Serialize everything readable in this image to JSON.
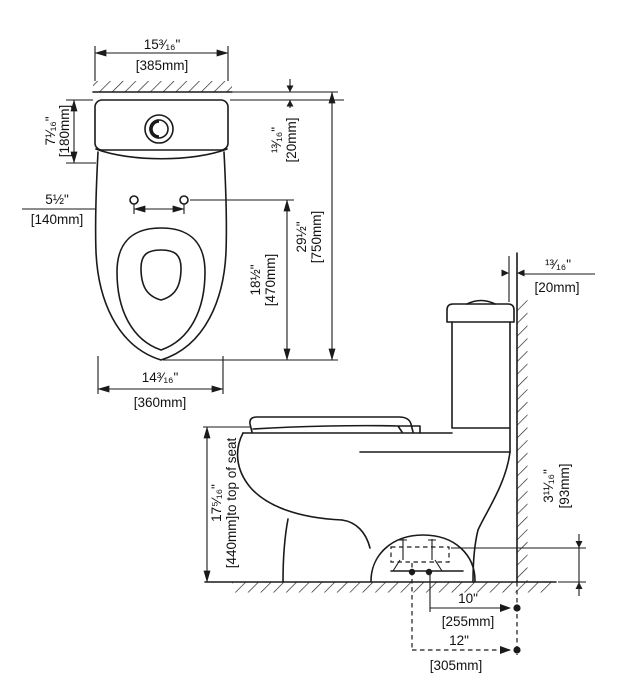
{
  "meta": {
    "line_color": "#1a1a1a",
    "bg_color": "#ffffff"
  },
  "plan": {
    "width": {
      "in": "15³⁄₁₆\"",
      "mm": "[385mm]"
    },
    "tank_depth": {
      "in": "7¹⁄₁₆\"",
      "mm": "[180mm]"
    },
    "bolt_spacing": {
      "in": "5½\"",
      "mm": "[140mm]"
    },
    "wall_gap": {
      "in": "¹³⁄₁₆\"",
      "mm": "[20mm]"
    },
    "overall_depth": {
      "in": "29½\"",
      "mm": "[750mm]"
    },
    "seat_length": {
      "in": "18½\"",
      "mm": "[470mm]"
    },
    "bowl_width": {
      "in": "14³⁄₁₆\"",
      "mm": "[360mm]"
    }
  },
  "side": {
    "wall_gap": {
      "in": "¹³⁄₁₆\"",
      "mm": "[20mm]"
    },
    "seat_height": {
      "in": "17⁵⁄₁₆\"",
      "mm": "[440mm]to top of seat"
    },
    "outlet_height": {
      "in": "3¹¹⁄₁₆\"",
      "mm": "[93mm]"
    },
    "rough_in_10": {
      "in": "10\"",
      "mm": "[255mm]"
    },
    "rough_in_12": {
      "in": "12\"",
      "mm": "[305mm]"
    }
  }
}
